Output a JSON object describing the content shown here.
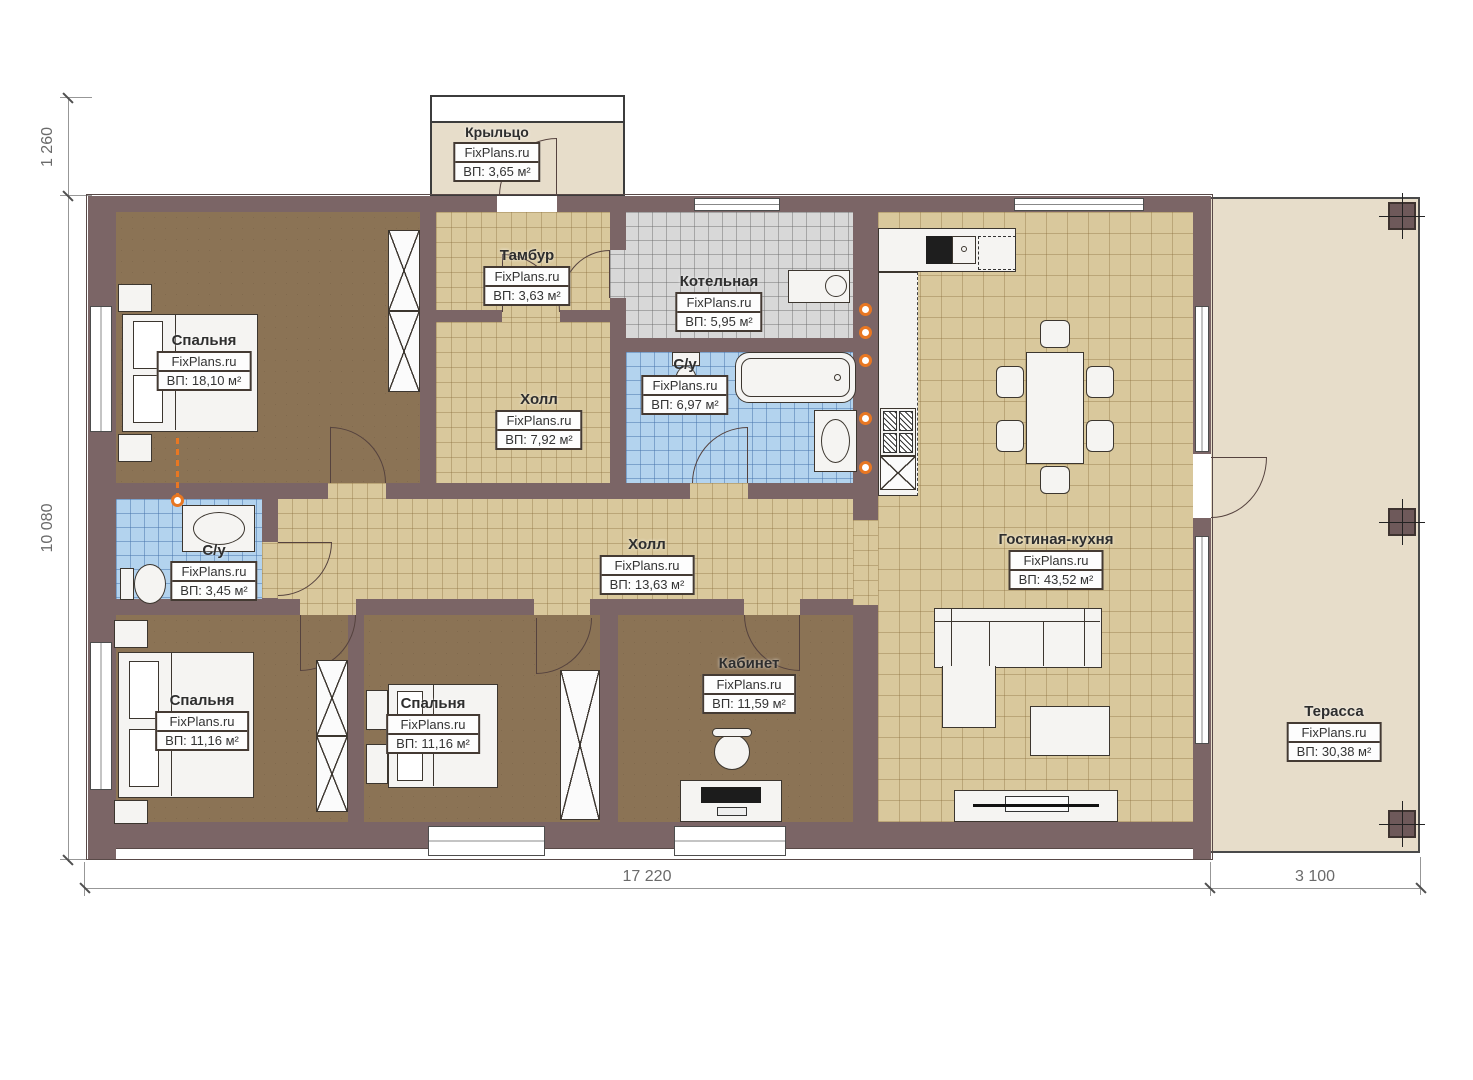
{
  "brand": "FixPlans.ru",
  "dimensions": {
    "left_top": "1 260",
    "left_main": "10 080",
    "bottom_main": "17 220",
    "bottom_right": "3 100"
  },
  "rooms": {
    "porch": {
      "name": "Крыльцо",
      "area": "ВП: 3,65 м²"
    },
    "bedroom1": {
      "name": "Спальня",
      "area": "ВП: 18,10 м²"
    },
    "tambour": {
      "name": "Тамбур",
      "area": "ВП: 3,63 м²"
    },
    "boiler": {
      "name": "Котельная",
      "area": "ВП: 5,95 м²"
    },
    "hall_upper": {
      "name": "Холл",
      "area": "ВП: 7,92 м²"
    },
    "bath_upper": {
      "name": "С/у",
      "area": "ВП: 6,97 м²"
    },
    "bath_left": {
      "name": "С/у",
      "area": "ВП: 3,45 м²"
    },
    "hall_main": {
      "name": "Холл",
      "area": "ВП: 13,63 м²"
    },
    "living_kitchen": {
      "name": "Гостиная-кухня",
      "area": "ВП: 43,52 м²"
    },
    "bedroom2": {
      "name": "Спальня",
      "area": "ВП: 11,16 м²"
    },
    "bedroom3": {
      "name": "Спальня",
      "area": "ВП: 11,16 м²"
    },
    "office": {
      "name": "Кабинет",
      "area": "ВП: 11,59 м²"
    },
    "terrace": {
      "name": "Терасса",
      "area": "ВП: 30,38 м²"
    }
  },
  "colors": {
    "wall": "#7b6566",
    "floor_wood": "#8b7355",
    "tile_tan": "#d9c89c",
    "tile_blue": "#b3d3ee",
    "tile_gray": "#d8d8d8",
    "outdoor": "#e7ddca",
    "accent_orange": "#e87722"
  }
}
